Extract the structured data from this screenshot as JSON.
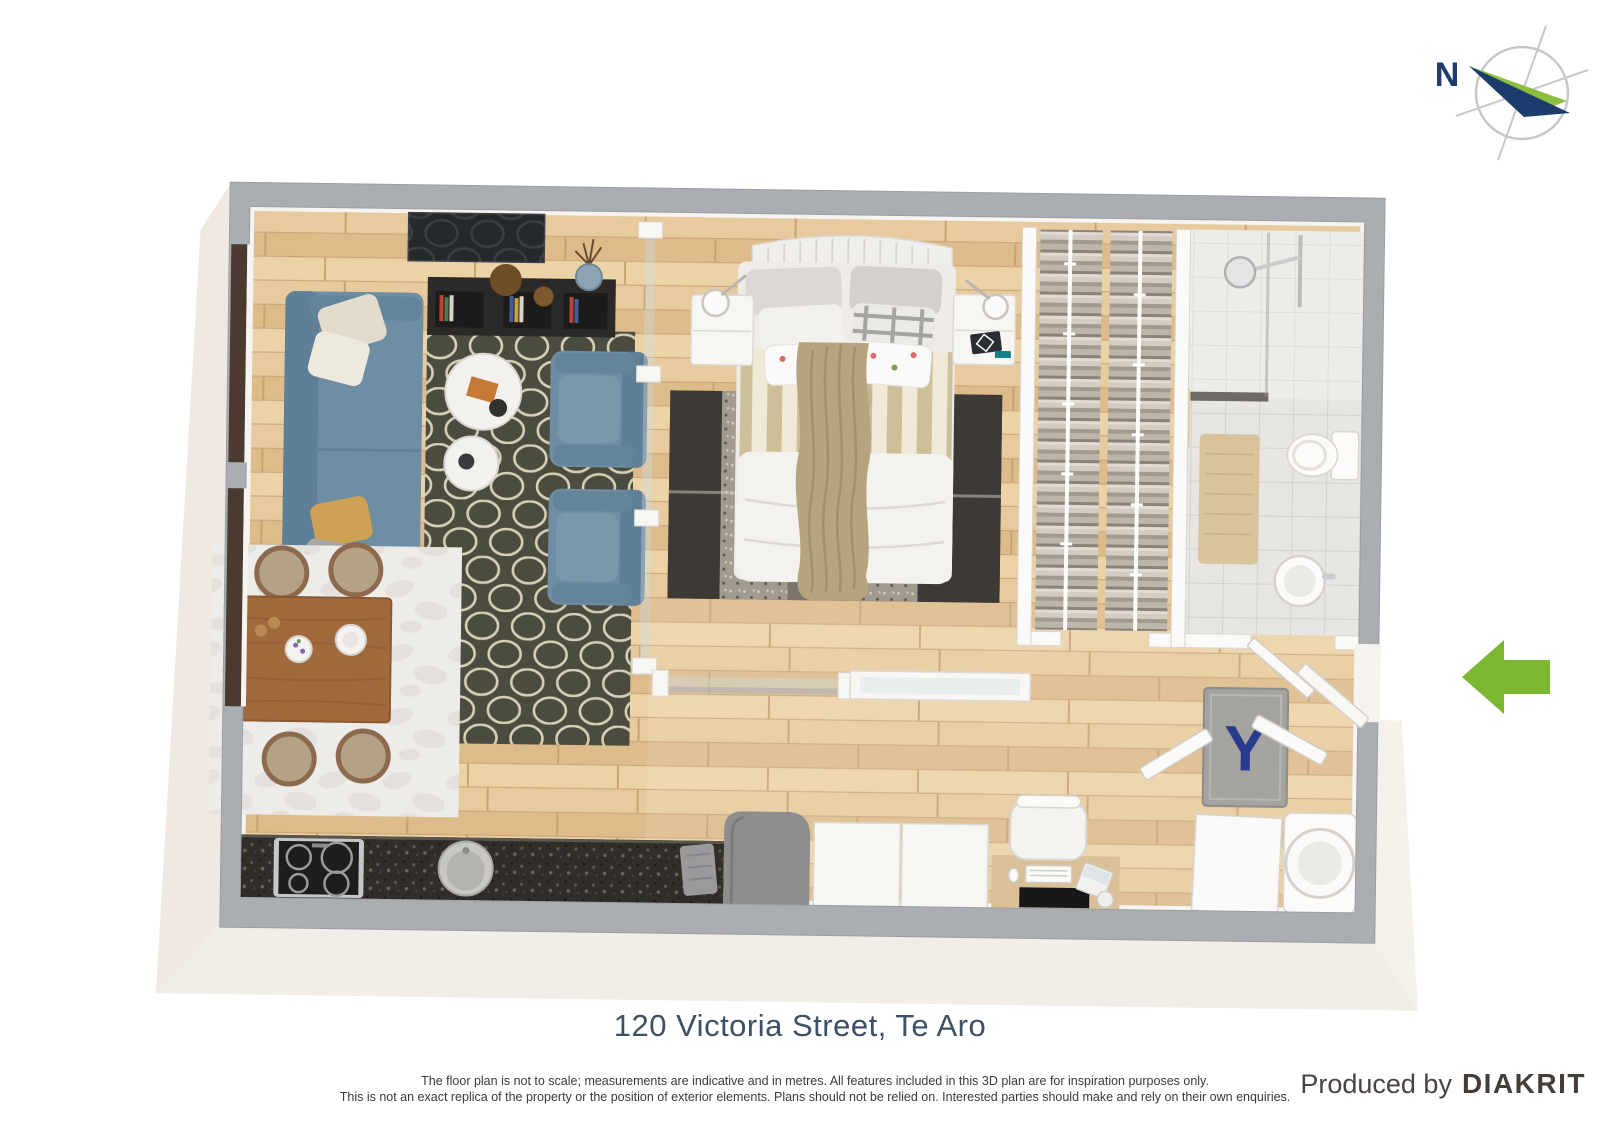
{
  "compass": {
    "label": "N"
  },
  "colors": {
    "arrow_green": "#7cb733",
    "compass_green": "#8cbf3f",
    "compass_navy": "#1d3c6e",
    "doormat_navy": "#2a3a8c",
    "title_blue": "#3d5166",
    "brand_gray": "#443d3a",
    "wall_gray": "#aaaeb3",
    "floor_wood": "#e3c294",
    "sofa_blue": "#6f8da3",
    "living_rug_olive": "#4c4b40",
    "counter_black": "#312e2a",
    "dining_table_wood": "#a06a3c"
  },
  "floor_plan": {
    "entry_arrow_direction": "left",
    "rooms": {
      "living_room": {
        "name": "Living room",
        "items": [
          "sofa",
          "armchair",
          "armchair",
          "nesting-coffee-tables",
          "trellis-rug",
          "wall-tv",
          "media-shelf",
          "vase",
          "floor-windows"
        ]
      },
      "dining_area": {
        "name": "Dining area",
        "items": [
          "dining-table",
          "four-chairs",
          "rug",
          "plates",
          "flowers"
        ]
      },
      "kitchen": {
        "name": "Kitchen",
        "items": [
          "stone-counter",
          "cooktop",
          "round-sink",
          "tea-towel"
        ]
      },
      "bedroom": {
        "name": "Bedroom",
        "items": [
          "double-bed",
          "headboard",
          "pillows",
          "striped-duvet",
          "knit-throw",
          "patch-rug",
          "nightstand",
          "nightstand",
          "reading-lamps",
          "glass-partition",
          "sliding-glass-door"
        ]
      },
      "walk_in_closet": {
        "name": "Walk-in closet",
        "items": [
          "hanging-clothes-rail",
          "hanging-clothes-rail"
        ]
      },
      "bathroom": {
        "name": "Bathroom",
        "items": [
          "walk-in-shower",
          "glass-screen",
          "toilet",
          "round-basin",
          "bath-mat",
          "towel"
        ]
      },
      "study_nook": {
        "name": "Study nook",
        "items": [
          "desk",
          "office-chair",
          "monitor",
          "keyboard",
          "laptop",
          "storage-cabinets"
        ]
      },
      "entry": {
        "name": "Entry",
        "doormat_text": "Y",
        "items": [
          "doormat",
          "open-entry-door",
          "washing-machine",
          "storage-cabinet",
          "open-doors"
        ]
      }
    }
  },
  "footer": {
    "title": "120 Victoria Street, Te Aro",
    "disclaimer_line1": "The floor plan is not to scale; measurements are indicative and in metres. All features included in this 3D plan are for inspiration purposes only.",
    "disclaimer_line2": "This is not an exact replica of the property or the position of exterior elements. Plans should not be relied on. Interested parties should make and rely on their own enquiries.",
    "produced_by": "Produced by",
    "brand": "DIAKRIT"
  }
}
